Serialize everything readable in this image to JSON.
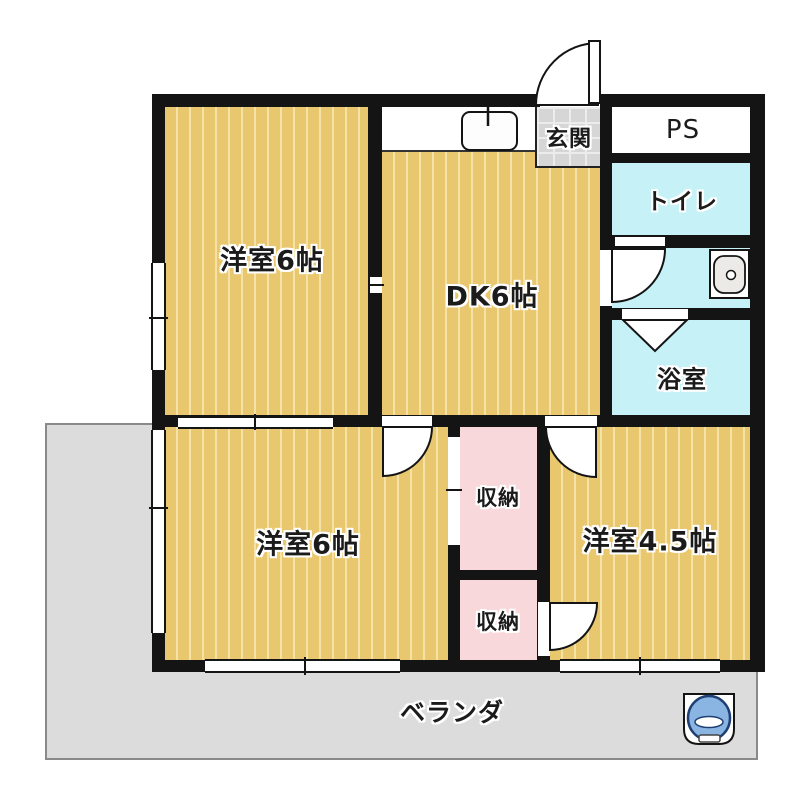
{
  "rooms": {
    "western6_top": {
      "label": "洋室6帖"
    },
    "dk": {
      "label": "DK6帖"
    },
    "entrance": {
      "label": "玄関"
    },
    "pipe_space": {
      "label": "PS"
    },
    "toilet": {
      "label": "トイレ"
    },
    "bath": {
      "label": "浴室"
    },
    "western6_bottom": {
      "label": "洋室6帖"
    },
    "closet_upper": {
      "label": "収納"
    },
    "closet_lower": {
      "label": "収納"
    },
    "western45": {
      "label": "洋室4.5帖"
    },
    "veranda": {
      "label": "ベランダ"
    }
  },
  "icons": {
    "washing_machine": "washing-machine-icon",
    "kitchen_sink": "kitchen-sink-icon",
    "washbasin": "washbasin-icon",
    "bath_folding_door": "folding-door-icon",
    "swing_door": "door-swing-icon"
  },
  "colors": {
    "floor_tan": "#e9c76f",
    "floor_stripe": "#f5e2a6",
    "closet_pink": "#f8d8da",
    "wet_area_cyan": "#c6f1f6",
    "entry_gray": "#d6d6d6",
    "veranda_gray": "#dcdcdc",
    "wall_black": "#141414",
    "washer_blue": "#8ab4e2"
  }
}
